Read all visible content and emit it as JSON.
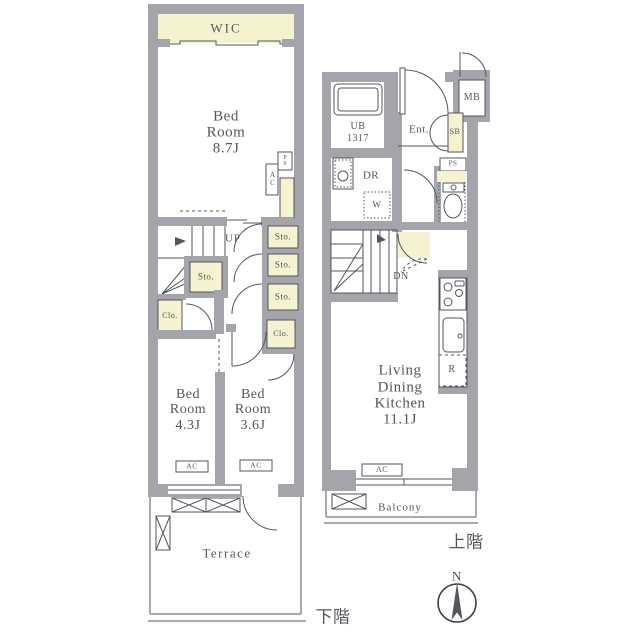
{
  "colors": {
    "wall": "#a4a4aa",
    "line": "#55555e",
    "closet_fill": "#f5f2d0",
    "text": "#55555e"
  },
  "lower_floor": {
    "floor_label": "下階",
    "wic": "WIC",
    "bedroom_main": {
      "l1": "Bed",
      "l2": "Room",
      "size": "8.7J"
    },
    "bedroom_2": {
      "l1": "Bed",
      "l2": "Room",
      "size": "4.3J"
    },
    "bedroom_3": {
      "l1": "Bed",
      "l2": "Room",
      "size": "3.6J"
    },
    "up": "UP",
    "storage": "Sto.",
    "closet": "Clo.",
    "ac": "AC",
    "ps": "PS",
    "terrace": "Terrace"
  },
  "upper_floor": {
    "floor_label": "上階",
    "unit_bath": {
      "l1": "UB",
      "l2": "1317"
    },
    "entrance": "Ent.",
    "shoe_box": "SB",
    "meter_box": "MB",
    "ps": "PS",
    "dressing_room": "DR",
    "washer": "W",
    "down": "DN",
    "ldk": {
      "l1": "Living",
      "l2": "Dining",
      "l3": "Kitchen",
      "size": "11.1J"
    },
    "refrigerator": "R",
    "ac": "AC",
    "balcony": "Balcony"
  },
  "compass": {
    "north": "N"
  }
}
